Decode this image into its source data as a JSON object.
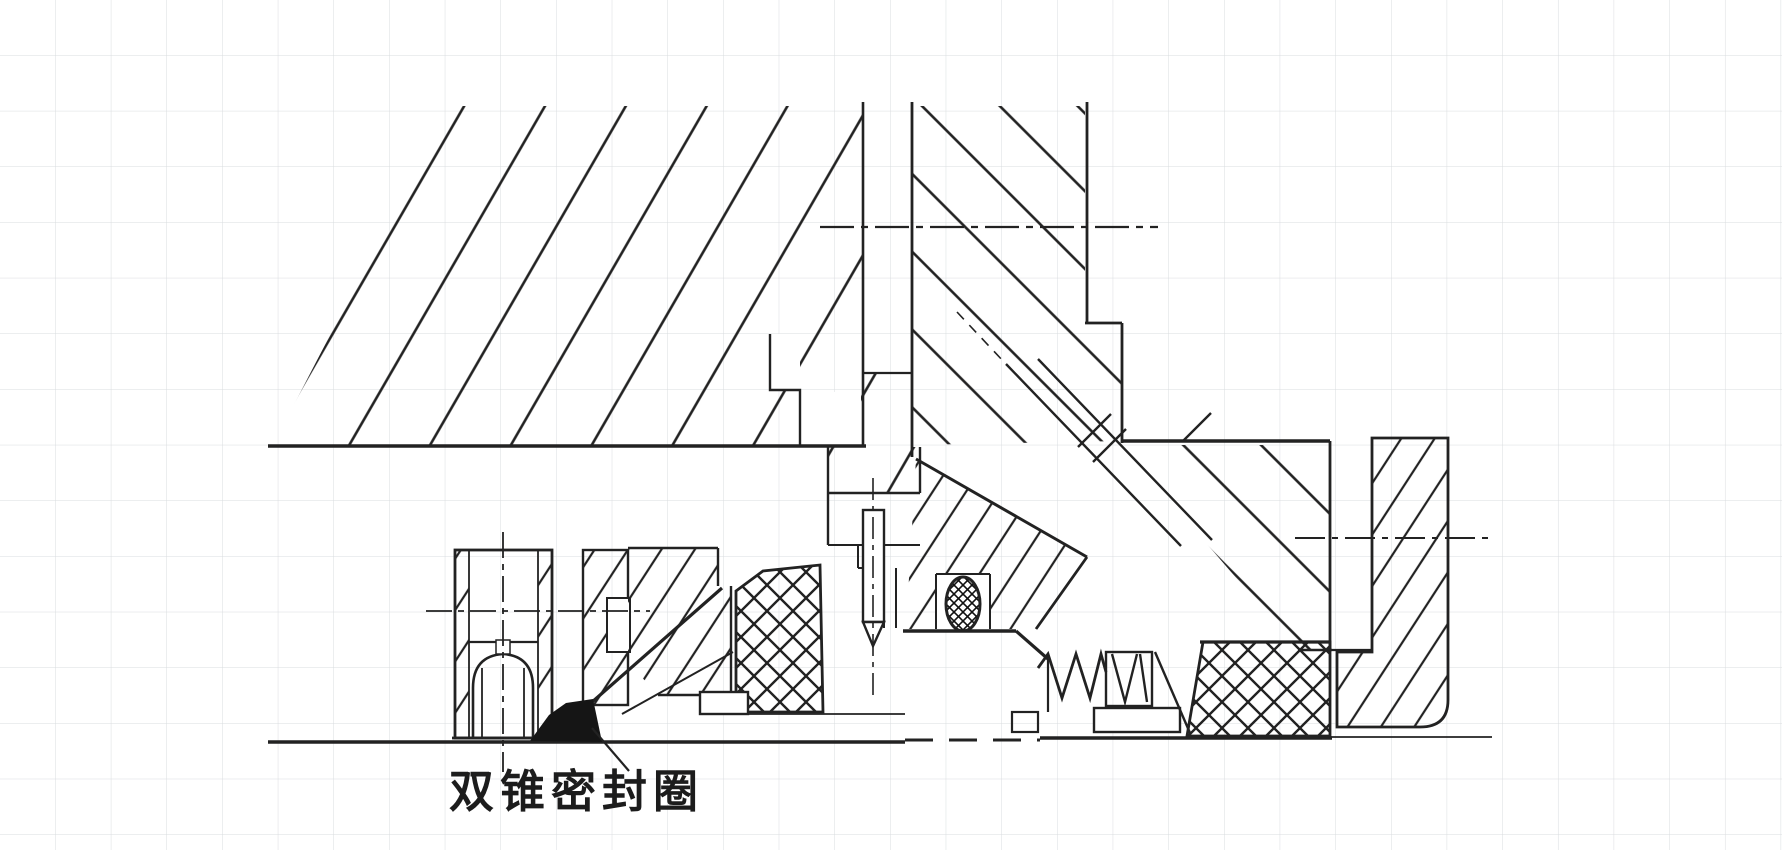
{
  "drawing": {
    "label": "双锥密封圈",
    "colors": {
      "background": "#ffffff",
      "grid_line": "#d9dcdf",
      "ink": "#222222",
      "seal_fill": "#151515"
    }
  }
}
